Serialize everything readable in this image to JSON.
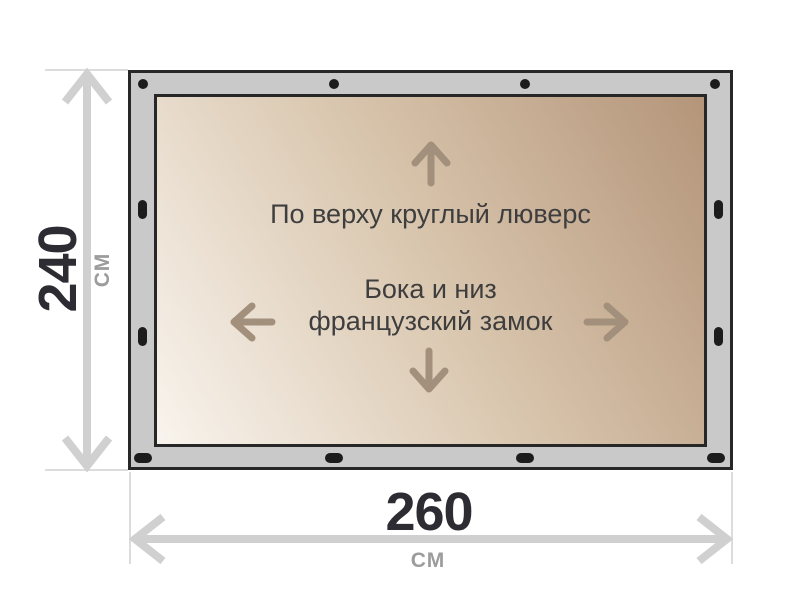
{
  "dimensions": {
    "height": {
      "value": "240",
      "unit": "см"
    },
    "width": {
      "value": "260",
      "unit": "см"
    }
  },
  "annotations": {
    "top_edge": "По верху круглый люверс",
    "sides_line1": "Бока и низ",
    "sides_line2": "французский замок"
  },
  "icons": {
    "top_edge_arrow": "arrow-up",
    "left_edge_arrow": "arrow-left",
    "right_edge_arrow": "arrow-right",
    "bottom_edge_arrow": "arrow-down",
    "height_dimension": "double-headed-vertical-arrow",
    "width_dimension": "double-headed-horizontal-arrow",
    "fasteners": "grommet-dots"
  },
  "colors": {
    "frame_fill": "#c9c9c9",
    "frame_border": "#272727",
    "grommet": "#1c1c1c",
    "tarp_light": "#f9f4ee",
    "tarp_mid": "#d9c6ae",
    "tarp_dark": "#b4957a",
    "dim_line": "#d0d0d0",
    "ext_line": "#dcdcdc",
    "dim_text": "#2c2c32",
    "unit_text": "#9c9c9c",
    "annotation_text": "#3e3e3e",
    "inner_arrow": "#a2907c",
    "bg": "#ffffff"
  }
}
